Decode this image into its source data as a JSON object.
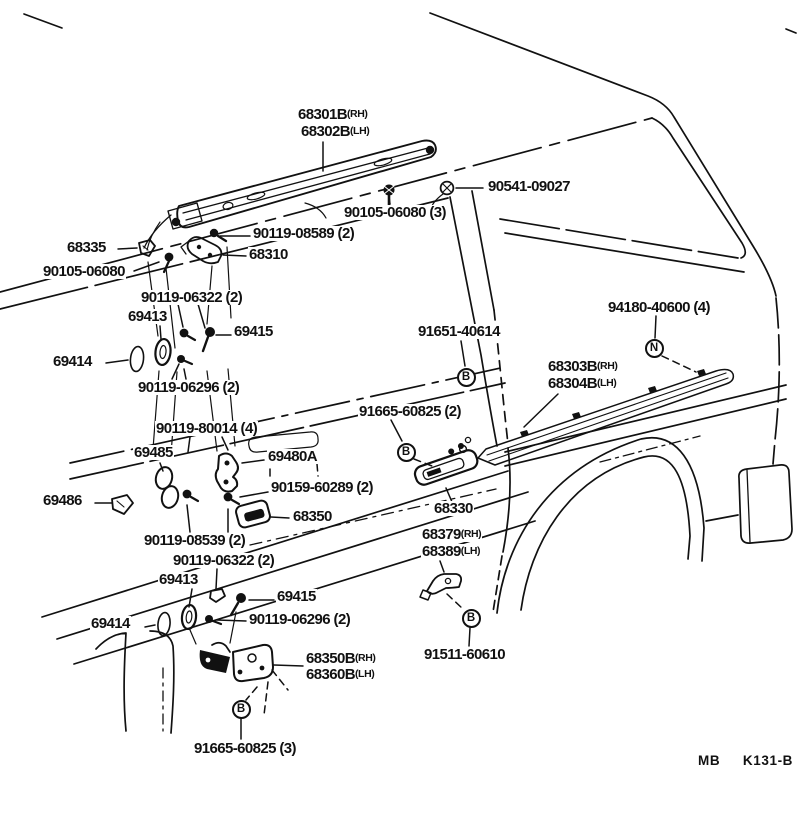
{
  "footer": {
    "code": "MB  K131-B"
  },
  "callouts": [
    {
      "text": "68301B",
      "suffix": "(RH)",
      "x": 297,
      "y": 107
    },
    {
      "text": "68302B",
      "suffix": "(LH)",
      "x": 300,
      "y": 124
    },
    {
      "text": "90541-09027",
      "x": 487,
      "y": 179
    },
    {
      "text": "90105-06080 (3)",
      "x": 343,
      "y": 205
    },
    {
      "text": "90119-08589 (2)",
      "x": 252,
      "y": 226
    },
    {
      "text": "68335",
      "x": 66,
      "y": 240
    },
    {
      "text": "68310",
      "x": 248,
      "y": 247
    },
    {
      "text": "90105-06080",
      "x": 42,
      "y": 264
    },
    {
      "text": "90119-06322 (2)",
      "x": 140,
      "y": 290
    },
    {
      "text": "69413",
      "x": 127,
      "y": 309
    },
    {
      "text": "69415",
      "x": 233,
      "y": 324
    },
    {
      "text": "69414",
      "x": 52,
      "y": 354
    },
    {
      "text": "90119-06296 (2)",
      "x": 137,
      "y": 380
    },
    {
      "text": "94180-40600 (4)",
      "x": 607,
      "y": 300
    },
    {
      "text": "91651-40614",
      "x": 417,
      "y": 324
    },
    {
      "text": "68303B",
      "suffix": "(RH)",
      "x": 547,
      "y": 359
    },
    {
      "text": "68304B",
      "suffix": "(LH)",
      "x": 547,
      "y": 376
    },
    {
      "text": "91665-60825 (2)",
      "x": 358,
      "y": 404
    },
    {
      "text": "90119-80014 (4)",
      "x": 155,
      "y": 421
    },
    {
      "text": "69485",
      "x": 133,
      "y": 445
    },
    {
      "text": "69480A",
      "x": 267,
      "y": 449
    },
    {
      "text": "90159-60289 (2)",
      "x": 270,
      "y": 480
    },
    {
      "text": "69486",
      "x": 42,
      "y": 493
    },
    {
      "text": "68350",
      "x": 292,
      "y": 509
    },
    {
      "text": "68330",
      "x": 433,
      "y": 501
    },
    {
      "text": "90119-08539 (2)",
      "x": 143,
      "y": 533
    },
    {
      "text": "90119-06322 (2)",
      "x": 172,
      "y": 553
    },
    {
      "text": "68379",
      "suffix": "(RH)",
      "x": 421,
      "y": 527
    },
    {
      "text": "68389",
      "suffix": "(LH)",
      "x": 421,
      "y": 544
    },
    {
      "text": "69413",
      "x": 158,
      "y": 572
    },
    {
      "text": "69415",
      "x": 276,
      "y": 589
    },
    {
      "text": "90119-06296 (2)",
      "x": 248,
      "y": 612
    },
    {
      "text": "69414",
      "x": 90,
      "y": 616
    },
    {
      "text": "68350B",
      "suffix": "(RH)",
      "x": 305,
      "y": 651
    },
    {
      "text": "68360B",
      "suffix": "(LH)",
      "x": 305,
      "y": 667
    },
    {
      "text": "91511-60610",
      "x": 423,
      "y": 647
    },
    {
      "text": "91665-60825 (3)",
      "x": 193,
      "y": 741
    }
  ],
  "markers": [
    {
      "letter": "B",
      "cx": 466,
      "cy": 377
    },
    {
      "letter": "N",
      "cx": 654,
      "cy": 348
    },
    {
      "letter": "B",
      "cx": 406,
      "cy": 452
    },
    {
      "letter": "B",
      "cx": 471,
      "cy": 618
    },
    {
      "letter": "B",
      "cx": 241,
      "cy": 709
    }
  ]
}
